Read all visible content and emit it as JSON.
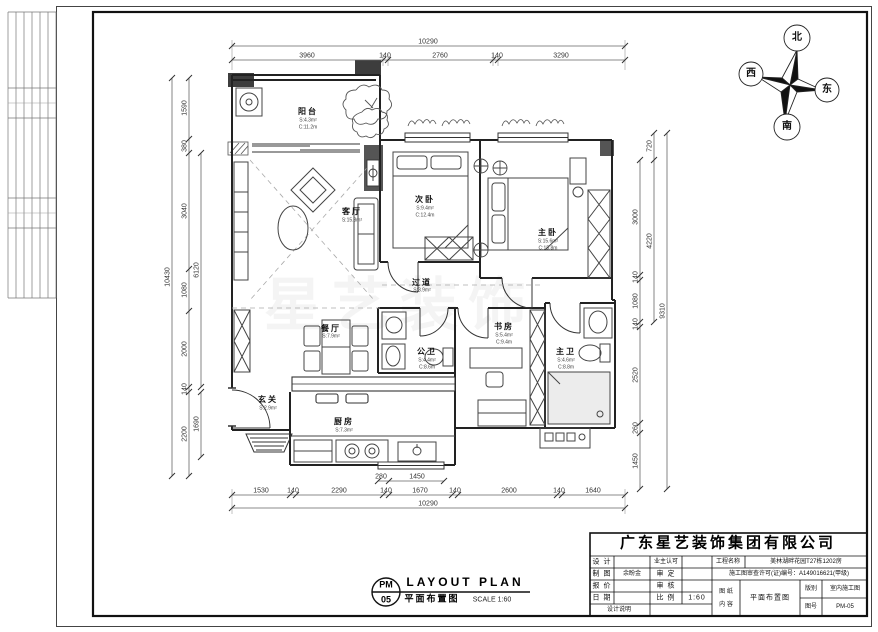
{
  "compass": {
    "north": "北",
    "south": "南",
    "east": "东",
    "west": "西"
  },
  "rooms": {
    "balcony": {
      "label": "阳台",
      "area": "S:4.3m²",
      "perimeter": "C:11.2m"
    },
    "living": {
      "label": "客厅",
      "area": "S:15.3m²"
    },
    "bedroom2": {
      "label": "次卧",
      "area": "S:9.4m²",
      "perimeter": "C:12.4m"
    },
    "master": {
      "label": "主卧",
      "area": "S:15.6m²",
      "perimeter": "C:15.8m"
    },
    "corridor": {
      "label": "过道",
      "area": "S:3.9m²"
    },
    "dining": {
      "label": "餐厅",
      "area": "S:7.9m²"
    },
    "study": {
      "label": "书房",
      "area": "S:5.4m²",
      "perimeter": "C:9.4m"
    },
    "bath_public": {
      "label": "公卫",
      "area": "S:4.4m²",
      "perimeter": "C:8.6m"
    },
    "bath_master": {
      "label": "主卫",
      "area": "S:4.6m²",
      "perimeter": "C:8.8m"
    },
    "entry": {
      "label": "玄关",
      "area": "S:2.9m²"
    },
    "kitchen": {
      "label": "厨房",
      "area": "S:7.3m²"
    }
  },
  "dimensions": {
    "top": {
      "total": "10290",
      "segments": [
        "3960",
        "140",
        "2760",
        "140",
        "3290"
      ]
    },
    "bottom": {
      "total": "10290",
      "partial": [
        "280",
        "1450"
      ],
      "segments": [
        "1530",
        "140",
        "2290",
        "140",
        "1670",
        "140",
        "2600",
        "140",
        "1640"
      ]
    },
    "left": {
      "total": "10430",
      "inner": [
        "6120",
        "1690"
      ],
      "segments": [
        "1590",
        "380",
        "3040",
        "1080",
        "2000",
        "140",
        "2200"
      ]
    },
    "right": {
      "total": "9310",
      "inner": [
        "720",
        "4220"
      ],
      "segments": [
        "3000",
        "140",
        "1080",
        "140",
        "2520",
        "260",
        "1450"
      ]
    }
  },
  "title_block": {
    "company": "广东星艺装饰集团有限公司",
    "design_label": "设 计",
    "owner_label": "业主认可",
    "project_label": "工程名称",
    "project_value": "美林湖畔花园T27栋1202房",
    "draft_label": "制 图",
    "draft_value": "余盼金",
    "approve_label": "审 定",
    "permit_text": "施工图审查许可(证)编号：A149016621(甲级)",
    "quote_label": "报 价",
    "review_label": "审 核",
    "date_label": "日 期",
    "scale_label": "比 例",
    "scale_value": "1:60",
    "note_label": "设计说明",
    "content_label_1": "图 纸",
    "content_label_2": "内 容",
    "content_value": "平面布置图",
    "version_label": "版别",
    "version_value": "室内施工图",
    "number_label": "图号",
    "number_value": "PM-05"
  },
  "footer": {
    "code_top": "PM",
    "code_bottom": "05",
    "title_en": "LAYOUT PLAN",
    "title_cn": "平面布置图",
    "scale": "SCALE 1:60"
  },
  "watermark": "星艺装饰"
}
